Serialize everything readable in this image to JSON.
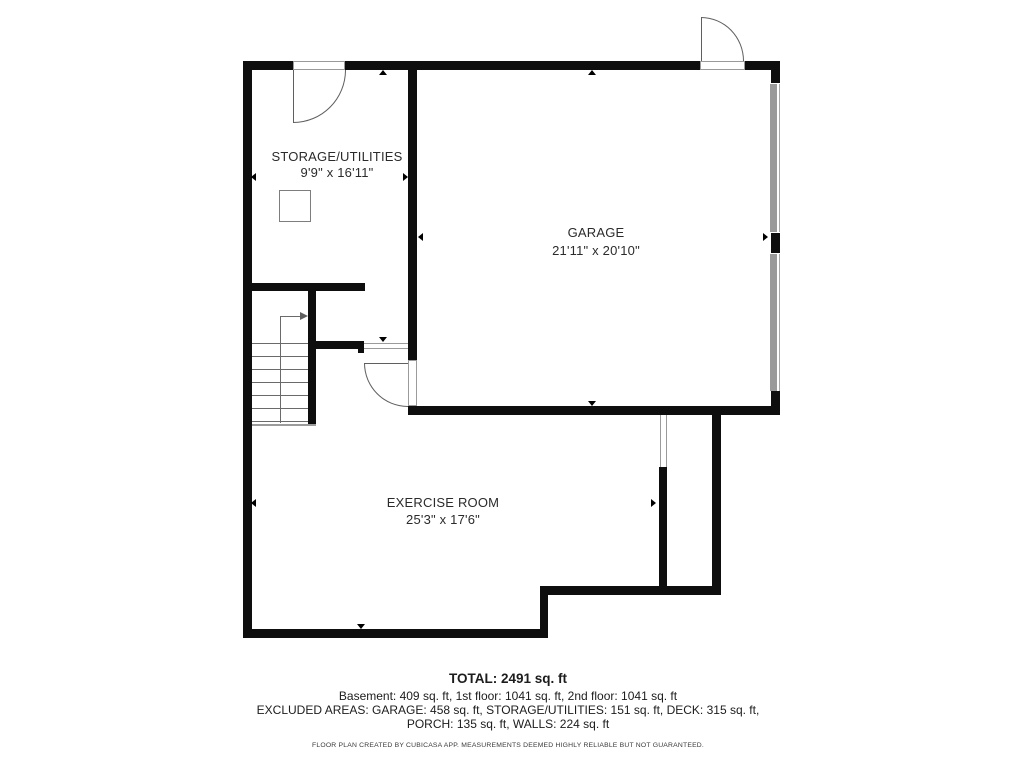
{
  "floor_plan": {
    "rooms": [
      {
        "name": "STORAGE/UTILITIES",
        "dimensions": "9'9\" x 16'11\""
      },
      {
        "name": "GARAGE",
        "dimensions": "21'11\" x 20'10\""
      },
      {
        "name": "EXERCISE ROOM",
        "dimensions": "25'3\" x 17'6\""
      }
    ],
    "summary": {
      "total": "TOTAL: 2491 sq. ft",
      "floors": "Basement: 409 sq. ft, 1st floor: 1041 sq. ft, 2nd floor: 1041 sq. ft",
      "excluded_line1": "EXCLUDED AREAS: GARAGE: 458 sq. ft, STORAGE/UTILITIES: 151 sq. ft, DECK: 315 sq. ft,",
      "excluded_line2": "PORCH: 135 sq. ft, WALLS: 224 sq. ft"
    },
    "disclaimer": "FLOOR PLAN CREATED BY CUBICASA APP. MEASUREMENTS DEEMED HIGHLY RELIABLE BUT NOT GUARANTEED.",
    "colors": {
      "wall": "#0e0e0e",
      "garage_door": "#9a9a9a",
      "text": "#2b2b2b"
    }
  }
}
